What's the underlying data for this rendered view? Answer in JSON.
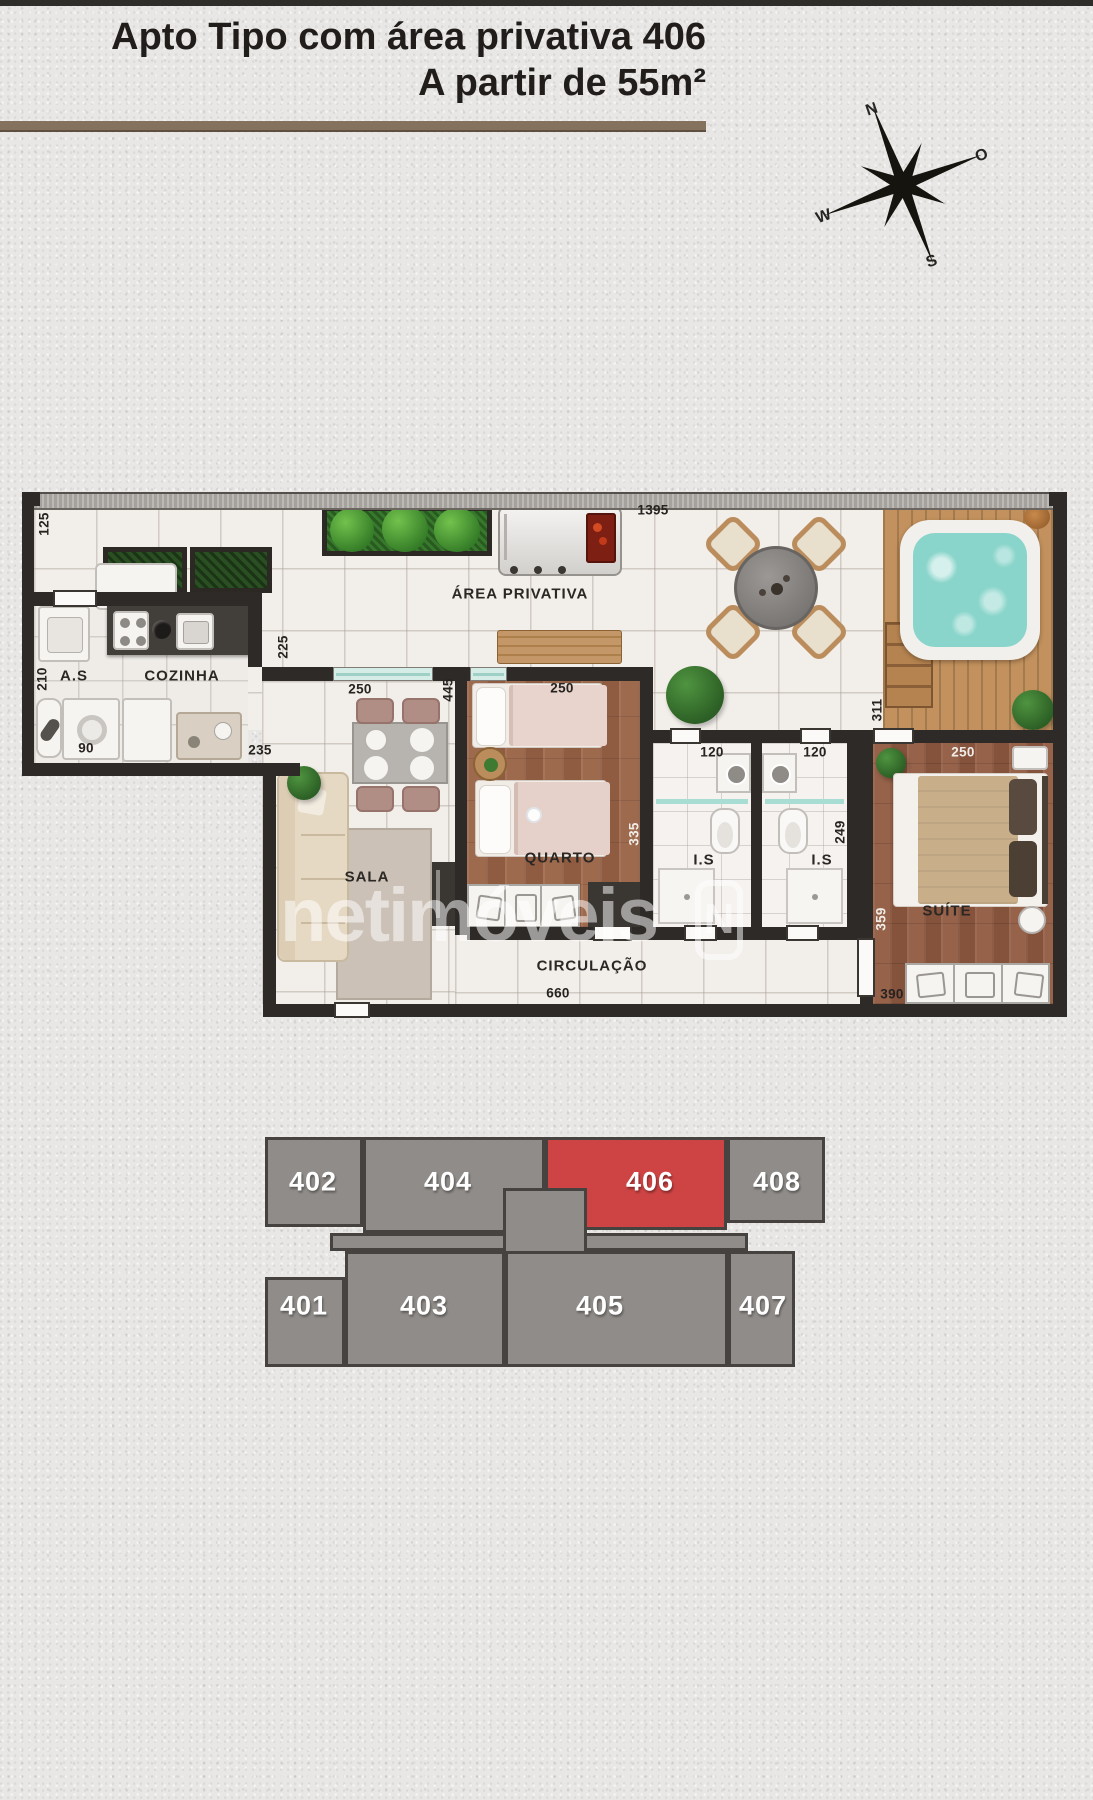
{
  "title": {
    "line1": "Apto Tipo com área privativa 406",
    "line2": "A partir de 55m²"
  },
  "compass": {
    "north": "N",
    "east": "O",
    "west": "W",
    "south": "S"
  },
  "floorplan": {
    "rooms": {
      "service_area": "A.S",
      "kitchen": "COZINHA",
      "private_area": "ÁREA PRIVATIVA",
      "living": "SALA",
      "bedroom": "QUARTO",
      "bath1": "I.S",
      "bath2": "I.S",
      "suite": "SUÍTE",
      "hall": "CIRCULAÇÃO"
    },
    "dims": {
      "d125": "125",
      "d1395": "1395",
      "d210": "210",
      "d225": "225",
      "d90": "90",
      "d235": "235",
      "d250_living": "250",
      "d445": "445",
      "d250_bedroom": "250",
      "d335": "335",
      "d120_a": "120",
      "d120_b": "120",
      "d249": "249",
      "d311": "311",
      "d250_suite": "250",
      "d359": "359",
      "d390": "390",
      "d660": "660"
    }
  },
  "watermark": {
    "text": "netimóveis",
    "logo_letter": "N"
  },
  "keyplan": {
    "highlighted": "406",
    "units": {
      "u402": "402",
      "u404": "404",
      "u406": "406",
      "u408": "408",
      "u401": "401",
      "u403": "403",
      "u405": "405",
      "u407": "407"
    }
  },
  "colors": {
    "accent_red": "#ce4343",
    "keyplan_gray": "#908c89",
    "wall": "#2e2a27",
    "divider_brown": "#84715e",
    "water": "#8ad5cb",
    "deck_wood": "#c2915d",
    "floor_wood": "#9a664b"
  }
}
